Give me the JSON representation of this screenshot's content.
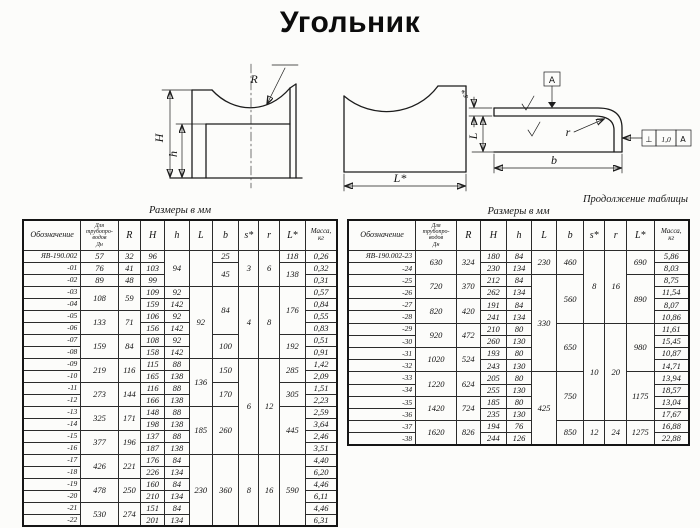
{
  "title": "Угольник",
  "drawings": {
    "side": {
      "label_R": "R",
      "label_H": "H",
      "label_h": "h"
    },
    "front": {
      "label_L": "L*"
    },
    "section": {
      "label_s": "s*",
      "label_L": "L",
      "label_b": "b",
      "label_r": "r",
      "datum": "A",
      "tol_symbol": "⊥",
      "tol_value": "1,0",
      "tol_datum": "A"
    }
  },
  "left_table": {
    "caption": "Размеры в мм",
    "headers": [
      "Обозначение",
      "Для\nтрубопро-\nводов\nДн",
      "R",
      "H",
      "h",
      "L",
      "b",
      "s*",
      "r",
      "L*",
      "Масса,\nкг"
    ],
    "rows": [
      [
        {
          "t": "ЯВ-190.002"
        },
        {
          "t": "57"
        },
        {
          "t": "32"
        },
        {
          "t": "96"
        },
        {
          "t": "94",
          "rs": 3
        },
        {
          "t": "",
          "rs": 3
        },
        {
          "t": "25"
        },
        {
          "t": "3",
          "rs": 3
        },
        {
          "t": "6",
          "rs": 3
        },
        {
          "t": "118"
        },
        {
          "t": "0,26"
        }
      ],
      [
        {
          "t": "-01"
        },
        {
          "t": "76"
        },
        {
          "t": "41"
        },
        {
          "t": "103"
        },
        {
          "t": "45",
          "rs": 2
        },
        {
          "t": "138",
          "rs": 2
        },
        {
          "t": "0,32"
        }
      ],
      [
        {
          "t": "-02"
        },
        {
          "t": "89"
        },
        {
          "t": "48"
        },
        {
          "t": "99"
        },
        {
          "t": "0,31"
        }
      ],
      [
        {
          "t": "-03"
        },
        {
          "t": "108",
          "rs": 2
        },
        {
          "t": "59",
          "rs": 2
        },
        {
          "t": "109"
        },
        {
          "t": "92"
        },
        {
          "t": "92",
          "rs": 6
        },
        {
          "t": "84",
          "rs": 4
        },
        {
          "t": "4",
          "rs": 6
        },
        {
          "t": "8",
          "rs": 6
        },
        {
          "t": "176",
          "rs": 4
        },
        {
          "t": "0,57"
        }
      ],
      [
        {
          "t": "-04"
        },
        {
          "t": "159"
        },
        {
          "t": "142"
        },
        {
          "t": "0,84"
        }
      ],
      [
        {
          "t": "-05"
        },
        {
          "t": "133",
          "rs": 2
        },
        {
          "t": "71",
          "rs": 2
        },
        {
          "t": "106"
        },
        {
          "t": "92"
        },
        {
          "t": "0,55"
        }
      ],
      [
        {
          "t": "-06"
        },
        {
          "t": "156"
        },
        {
          "t": "142"
        },
        {
          "t": "0,83"
        }
      ],
      [
        {
          "t": "-07"
        },
        {
          "t": "159",
          "rs": 2
        },
        {
          "t": "84",
          "rs": 2
        },
        {
          "t": "108"
        },
        {
          "t": "92"
        },
        {
          "t": "100",
          "rs": 2
        },
        {
          "t": "192",
          "rs": 2
        },
        {
          "t": "0,51"
        }
      ],
      [
        {
          "t": "-08"
        },
        {
          "t": "158"
        },
        {
          "t": "142"
        },
        {
          "t": "0,91"
        }
      ],
      [
        {
          "t": "-09"
        },
        {
          "t": "219",
          "rs": 2
        },
        {
          "t": "116",
          "rs": 2
        },
        {
          "t": "115"
        },
        {
          "t": "88"
        },
        {
          "t": "136",
          "rs": 4
        },
        {
          "t": "150",
          "rs": 2
        },
        {
          "t": "6",
          "rs": 8
        },
        {
          "t": "12",
          "rs": 8
        },
        {
          "t": "285",
          "rs": 2
        },
        {
          "t": "1,42"
        }
      ],
      [
        {
          "t": "-10"
        },
        {
          "t": "165"
        },
        {
          "t": "138"
        },
        {
          "t": "2,09"
        }
      ],
      [
        {
          "t": "-11"
        },
        {
          "t": "273",
          "rs": 2
        },
        {
          "t": "144",
          "rs": 2
        },
        {
          "t": "116"
        },
        {
          "t": "88"
        },
        {
          "t": "170",
          "rs": 2
        },
        {
          "t": "305",
          "rs": 2
        },
        {
          "t": "1,51"
        }
      ],
      [
        {
          "t": "-12"
        },
        {
          "t": "166"
        },
        {
          "t": "138"
        },
        {
          "t": "2,23"
        }
      ],
      [
        {
          "t": "-13"
        },
        {
          "t": "325",
          "rs": 2
        },
        {
          "t": "171",
          "rs": 2
        },
        {
          "t": "148"
        },
        {
          "t": "88"
        },
        {
          "t": "185",
          "rs": 4
        },
        {
          "t": "260",
          "rs": 4
        },
        {
          "t": "445",
          "rs": 4
        },
        {
          "t": "2,59"
        }
      ],
      [
        {
          "t": "-14"
        },
        {
          "t": "198"
        },
        {
          "t": "138"
        },
        {
          "t": "3,64"
        }
      ],
      [
        {
          "t": "-15"
        },
        {
          "t": "377",
          "rs": 2
        },
        {
          "t": "196",
          "rs": 2
        },
        {
          "t": "137"
        },
        {
          "t": "88"
        },
        {
          "t": "2,46"
        }
      ],
      [
        {
          "t": "-16"
        },
        {
          "t": "187"
        },
        {
          "t": "138"
        },
        {
          "t": "3,51"
        }
      ],
      [
        {
          "t": "-17"
        },
        {
          "t": "426",
          "rs": 2
        },
        {
          "t": "221",
          "rs": 2
        },
        {
          "t": "176"
        },
        {
          "t": "84"
        },
        {
          "t": "230",
          "rs": 6
        },
        {
          "t": "360",
          "rs": 6
        },
        {
          "t": "8",
          "rs": 6
        },
        {
          "t": "16",
          "rs": 6
        },
        {
          "t": "590",
          "rs": 6
        },
        {
          "t": "4,40"
        }
      ],
      [
        {
          "t": "-18"
        },
        {
          "t": "226"
        },
        {
          "t": "134"
        },
        {
          "t": "6,20"
        }
      ],
      [
        {
          "t": "-19"
        },
        {
          "t": "478",
          "rs": 2
        },
        {
          "t": "250",
          "rs": 2
        },
        {
          "t": "160"
        },
        {
          "t": "84"
        },
        {
          "t": "4,46"
        }
      ],
      [
        {
          "t": "-20"
        },
        {
          "t": "210"
        },
        {
          "t": "134"
        },
        {
          "t": "6,11"
        }
      ],
      [
        {
          "t": "-21"
        },
        {
          "t": "530",
          "rs": 2
        },
        {
          "t": "274",
          "rs": 2
        },
        {
          "t": "151"
        },
        {
          "t": "84"
        },
        {
          "t": "4,46"
        }
      ],
      [
        {
          "t": "-22"
        },
        {
          "t": "201"
        },
        {
          "t": "134"
        },
        {
          "t": "6,31"
        }
      ]
    ]
  },
  "right_table": {
    "continuation": "Продолжение таблицы",
    "caption": "Размеры в мм",
    "headers": [
      "Обозначение",
      "Для\nтрубопро-\nводов\nДн",
      "R",
      "H",
      "h",
      "L",
      "b",
      "s*",
      "r",
      "L*",
      "Масса,\nкг"
    ],
    "rows": [
      [
        {
          "t": "ЯВ-190.002-23"
        },
        {
          "t": "630",
          "rs": 2
        },
        {
          "t": "324",
          "rs": 2
        },
        {
          "t": "180"
        },
        {
          "t": "84"
        },
        {
          "t": "230",
          "rs": 2
        },
        {
          "t": "460",
          "rs": 2
        },
        {
          "t": "8",
          "rs": 6
        },
        {
          "t": "16",
          "rs": 6
        },
        {
          "t": "690",
          "rs": 2
        },
        {
          "t": "5,86"
        }
      ],
      [
        {
          "t": "-24"
        },
        {
          "t": "230"
        },
        {
          "t": "134"
        },
        {
          "t": "8,03"
        }
      ],
      [
        {
          "t": "-25"
        },
        {
          "t": "720",
          "rs": 2
        },
        {
          "t": "370",
          "rs": 2
        },
        {
          "t": "212"
        },
        {
          "t": "84"
        },
        {
          "t": "330",
          "rs": 8
        },
        {
          "t": "560",
          "rs": 4
        },
        {
          "t": "890",
          "rs": 4
        },
        {
          "t": "8,75"
        }
      ],
      [
        {
          "t": "-26"
        },
        {
          "t": "262"
        },
        {
          "t": "134"
        },
        {
          "t": "11,54"
        }
      ],
      [
        {
          "t": "-27"
        },
        {
          "t": "820",
          "rs": 2
        },
        {
          "t": "420",
          "rs": 2
        },
        {
          "t": "191"
        },
        {
          "t": "84"
        },
        {
          "t": "8,07"
        }
      ],
      [
        {
          "t": "-28"
        },
        {
          "t": "241"
        },
        {
          "t": "134"
        },
        {
          "t": "10,86"
        }
      ],
      [
        {
          "t": "-29"
        },
        {
          "t": "920",
          "rs": 2
        },
        {
          "t": "472",
          "rs": 2
        },
        {
          "t": "210"
        },
        {
          "t": "80"
        },
        {
          "t": "650",
          "rs": 4
        },
        {
          "t": "10",
          "rs": 8
        },
        {
          "t": "20",
          "rs": 8
        },
        {
          "t": "980",
          "rs": 4
        },
        {
          "t": "11,61"
        }
      ],
      [
        {
          "t": "-30"
        },
        {
          "t": "260"
        },
        {
          "t": "130"
        },
        {
          "t": "15,45"
        }
      ],
      [
        {
          "t": "-31"
        },
        {
          "t": "1020",
          "rs": 2
        },
        {
          "t": "524",
          "rs": 2
        },
        {
          "t": "193"
        },
        {
          "t": "80"
        },
        {
          "t": "10,87"
        }
      ],
      [
        {
          "t": "-32"
        },
        {
          "t": "243"
        },
        {
          "t": "130"
        },
        {
          "t": "14,71"
        }
      ],
      [
        {
          "t": "-33"
        },
        {
          "t": "1220",
          "rs": 2
        },
        {
          "t": "624",
          "rs": 2
        },
        {
          "t": "205"
        },
        {
          "t": "80"
        },
        {
          "t": "425",
          "rs": 6
        },
        {
          "t": "750",
          "rs": 4
        },
        {
          "t": "1175",
          "rs": 4
        },
        {
          "t": "13,94"
        }
      ],
      [
        {
          "t": "-34"
        },
        {
          "t": "255"
        },
        {
          "t": "130"
        },
        {
          "t": "18,57"
        }
      ],
      [
        {
          "t": "-35"
        },
        {
          "t": "1420",
          "rs": 2
        },
        {
          "t": "724",
          "rs": 2
        },
        {
          "t": "185"
        },
        {
          "t": "80"
        },
        {
          "t": "13,04"
        }
      ],
      [
        {
          "t": "-36"
        },
        {
          "t": "235"
        },
        {
          "t": "130"
        },
        {
          "t": "17,67"
        }
      ],
      [
        {
          "t": "-37"
        },
        {
          "t": "1620",
          "rs": 2
        },
        {
          "t": "826",
          "rs": 2
        },
        {
          "t": "194"
        },
        {
          "t": "76"
        },
        {
          "t": "850",
          "rs": 2
        },
        {
          "t": "12",
          "rs": 2
        },
        {
          "t": "24",
          "rs": 2
        },
        {
          "t": "1275",
          "rs": 2
        },
        {
          "t": "16,88"
        }
      ],
      [
        {
          "t": "-38"
        },
        {
          "t": "244"
        },
        {
          "t": "126"
        },
        {
          "t": "22,88"
        }
      ]
    ]
  }
}
